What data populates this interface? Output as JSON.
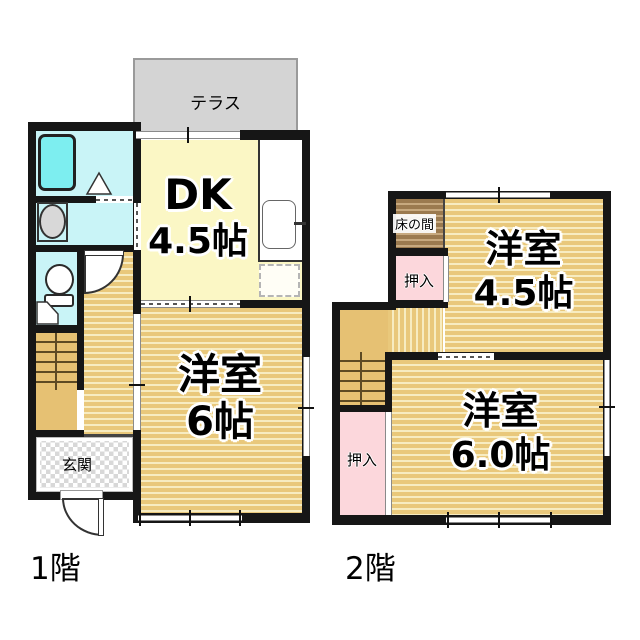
{
  "floor1": {
    "label": "1階",
    "terrace": "テラス",
    "genkan": "玄関",
    "dk": {
      "l1": "DK",
      "l2": "4.5帖"
    },
    "room6": {
      "l1": "洋室",
      "l2": "6帖"
    }
  },
  "floor2": {
    "label": "2階",
    "tokonoma": "床の間",
    "closet_upper": "押入",
    "closet_lower": "押入",
    "room45": {
      "l1": "洋室",
      "l2": "4.5帖"
    },
    "room60": {
      "l1": "洋室",
      "l2": "6.0帖"
    }
  },
  "palette": {
    "wall": "#161616",
    "wood_base": "#e9c87b",
    "wood_stripe": "#f7ecc1",
    "dk_yellow": "#fbf7c5",
    "water_cyan": "#c9f4f7",
    "bathtub_cyan": "#7deef0",
    "closet_pink": "#fcd7dc",
    "tokonoma_brown": "#9b7a4f",
    "terrace_gray": "#d4d4d4",
    "stair_tan": "#e6c173"
  }
}
